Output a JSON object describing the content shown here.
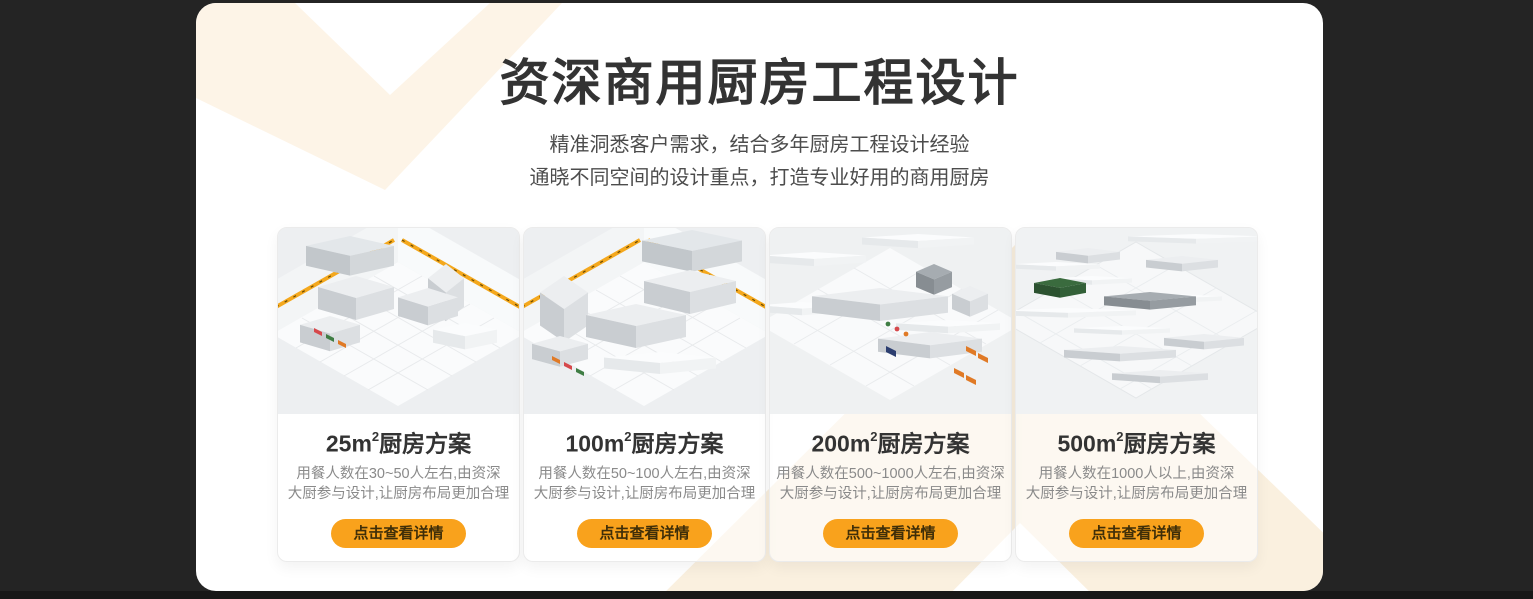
{
  "page": {
    "background_color": "#242424",
    "panel_background": "#ffffff"
  },
  "colors": {
    "accent_orange": "#F9A21C",
    "button_text": "#3f2e08",
    "chevron_light": "#FDF4E7",
    "chevron_warm": "#FAEEDC",
    "hazard_stripe_yellow": "#F4A81D",
    "title_text": "#333333",
    "description_text": "#8a8a8a"
  },
  "header": {
    "title": "资深商用厨房工程设计",
    "subtitle_line1": "精准洞悉客户需求，结合多年厨房工程设计经验",
    "subtitle_line2": "通晓不同空间的设计重点，打造专业好用的商用厨房"
  },
  "cards": [
    {
      "area": "25m",
      "sup": "2",
      "title_suffix": "厨房方案",
      "desc_line1": "用餐人数在30~50人左右,由资深",
      "desc_line2": "大厨参与设计,让厨房布局更加合理",
      "button_label": "点击查看详情",
      "image_name": "kitchen-render-25sqm"
    },
    {
      "area": "100m",
      "sup": "2",
      "title_suffix": "厨房方案",
      "desc_line1": "用餐人数在50~100人左右,由资深",
      "desc_line2": "大厨参与设计,让厨房布局更加合理",
      "button_label": "点击查看详情",
      "image_name": "kitchen-render-100sqm"
    },
    {
      "area": "200m",
      "sup": "2",
      "title_suffix": "厨房方案",
      "desc_line1": "用餐人数在500~1000人左右,由资深",
      "desc_line2": "大厨参与设计,让厨房布局更加合理",
      "button_label": "点击查看详情",
      "image_name": "kitchen-render-200sqm"
    },
    {
      "area": "500m",
      "sup": "2",
      "title_suffix": "厨房方案",
      "desc_line1": "用餐人数在1000人以上,由资深",
      "desc_line2": "大厨参与设计,让厨房布局更加合理",
      "button_label": "点击查看详情",
      "image_name": "kitchen-render-500sqm"
    }
  ]
}
